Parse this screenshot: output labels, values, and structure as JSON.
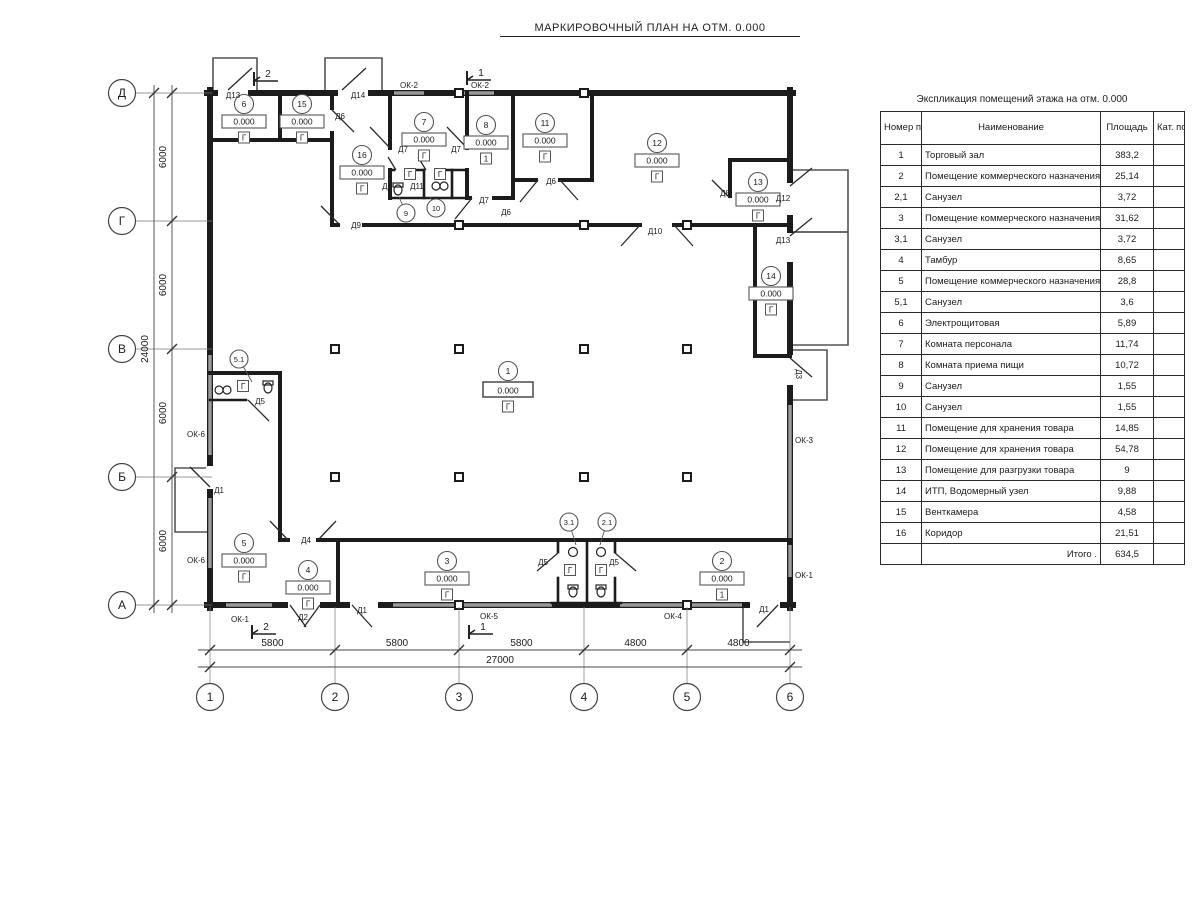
{
  "title": "МАРКИРОВОЧНЫЙ ПЛАН НА ОТМ. 0.000",
  "schedule": {
    "title": "Экспликация помещений этажа на отм. 0.000",
    "headers": {
      "number": "Номер помещ.",
      "name": "Наименование",
      "area": "Площадь",
      "category": "Кат. пом."
    },
    "rows": [
      {
        "number": "1",
        "name": "Торговый зал",
        "area": "383,2",
        "category": ""
      },
      {
        "number": "2",
        "name": "Помещение коммерческого назначения",
        "area": "25,14",
        "category": ""
      },
      {
        "number": "2,1",
        "name": "Санузел",
        "area": "3,72",
        "category": ""
      },
      {
        "number": "3",
        "name": "Помещение коммерческого назначения",
        "area": "31,62",
        "category": ""
      },
      {
        "number": "3,1",
        "name": "Санузел",
        "area": "3,72",
        "category": ""
      },
      {
        "number": "4",
        "name": "Тамбур",
        "area": "8,65",
        "category": ""
      },
      {
        "number": "5",
        "name": "Помещение коммерческого назначения",
        "area": "28,8",
        "category": ""
      },
      {
        "number": "5,1",
        "name": "Санузел",
        "area": "3,6",
        "category": ""
      },
      {
        "number": "6",
        "name": "Электрощитовая",
        "area": "5,89",
        "category": ""
      },
      {
        "number": "7",
        "name": "Комната персонала",
        "area": "11,74",
        "category": ""
      },
      {
        "number": "8",
        "name": "Комната приема пищи",
        "area": "10,72",
        "category": ""
      },
      {
        "number": "9",
        "name": "Санузел",
        "area": "1,55",
        "category": ""
      },
      {
        "number": "10",
        "name": "Санузел",
        "area": "1,55",
        "category": ""
      },
      {
        "number": "11",
        "name": "Помещение для хранения товара",
        "area": "14,85",
        "category": ""
      },
      {
        "number": "12",
        "name": "Помещение для хранения товара",
        "area": "54,78",
        "category": ""
      },
      {
        "number": "13",
        "name": "Помещение для разгрузки товара",
        "area": "9",
        "category": ""
      },
      {
        "number": "14",
        "name": "ИТП, Водомерный узел",
        "area": "9,88",
        "category": ""
      },
      {
        "number": "15",
        "name": "Венткамера",
        "area": "4,58",
        "category": ""
      },
      {
        "number": "16",
        "name": "Коридор",
        "area": "21,51",
        "category": ""
      }
    ],
    "total_label": "Итого .",
    "total_value": "634,5"
  },
  "plan": {
    "elevation": "0.000",
    "axes": {
      "vertical": [
        {
          "label": "Д",
          "y": 93
        },
        {
          "label": "Г",
          "y": 221
        },
        {
          "label": "В",
          "y": 349
        },
        {
          "label": "Б",
          "y": 477
        },
        {
          "label": "А",
          "y": 605
        }
      ],
      "horizontal": [
        {
          "label": "1",
          "x": 210
        },
        {
          "label": "2",
          "x": 335
        },
        {
          "label": "3",
          "x": 459
        },
        {
          "label": "4",
          "x": 584
        },
        {
          "label": "5",
          "x": 687
        },
        {
          "label": "6",
          "x": 790
        }
      ]
    },
    "dimensions": {
      "vertical_segments": [
        "6000",
        "6000",
        "6000",
        "6000"
      ],
      "vertical_total": "24000",
      "horizontal_segments": [
        "5800",
        "5800",
        "5800",
        "4800",
        "4800"
      ],
      "horizontal_total": "27000"
    },
    "room_markers": [
      {
        "n": "1",
        "x": 508,
        "y": 371,
        "cat": "Г",
        "big": true
      },
      {
        "n": "2",
        "x": 722,
        "y": 561,
        "cat": "1"
      },
      {
        "n": "3",
        "x": 447,
        "y": 561,
        "cat": "Г"
      },
      {
        "n": "4",
        "x": 308,
        "y": 570,
        "cat": "Г"
      },
      {
        "n": "5",
        "x": 244,
        "y": 543,
        "cat": "Г"
      },
      {
        "n": "6",
        "x": 244,
        "y": 104,
        "cat": "Г"
      },
      {
        "n": "7",
        "x": 424,
        "y": 122,
        "cat": "Г"
      },
      {
        "n": "8",
        "x": 486,
        "y": 125,
        "cat": "1"
      },
      {
        "n": "11",
        "x": 545,
        "y": 123,
        "cat": "Г"
      },
      {
        "n": "12",
        "x": 657,
        "y": 143,
        "cat": "Г"
      },
      {
        "n": "13",
        "x": 758,
        "y": 182,
        "cat": "Г"
      },
      {
        "n": "14",
        "x": 771,
        "y": 276,
        "cat": "Г"
      },
      {
        "n": "15",
        "x": 302,
        "y": 104,
        "cat": "Г"
      },
      {
        "n": "16",
        "x": 362,
        "y": 155,
        "cat": "Г"
      }
    ],
    "circle_markers": [
      {
        "n": "5.1",
        "x": 239,
        "y": 359,
        "lx": 252,
        "ly": 382
      },
      {
        "n": "3.1",
        "x": 569,
        "y": 522,
        "lx": 576,
        "ly": 545
      },
      {
        "n": "2.1",
        "x": 607,
        "y": 522,
        "lx": 600,
        "ly": 545
      },
      {
        "n": "9",
        "x": 406,
        "y": 213,
        "lx": 399,
        "ly": 197
      },
      {
        "n": "10",
        "x": 436,
        "y": 208,
        "lx": 430,
        "ly": 197
      }
    ],
    "cat_boxes": [
      {
        "t": "Г",
        "x": 243,
        "y": 389
      },
      {
        "t": "Г",
        "x": 570,
        "y": 573
      },
      {
        "t": "Г",
        "x": 601,
        "y": 573
      },
      {
        "t": "Г",
        "x": 410,
        "y": 177
      },
      {
        "t": "Г",
        "x": 440,
        "y": 177
      }
    ],
    "door_labels": [
      {
        "t": "Д13",
        "x": 233,
        "y": 98
      },
      {
        "t": "Д14",
        "x": 358,
        "y": 98
      },
      {
        "t": "Д6",
        "x": 340,
        "y": 119
      },
      {
        "t": "Д7",
        "x": 403,
        "y": 152
      },
      {
        "t": "Д7",
        "x": 456,
        "y": 152
      },
      {
        "t": "Д5",
        "x": 387,
        "y": 189
      },
      {
        "t": "Д11",
        "x": 417,
        "y": 189
      },
      {
        "t": "Д7",
        "x": 484,
        "y": 203
      },
      {
        "t": "Д6",
        "x": 506,
        "y": 215
      },
      {
        "t": "Д6",
        "x": 551,
        "y": 184
      },
      {
        "t": "Д9",
        "x": 356,
        "y": 228
      },
      {
        "t": "Д10",
        "x": 655,
        "y": 234
      },
      {
        "t": "Д8",
        "x": 725,
        "y": 196
      },
      {
        "t": "Д12",
        "x": 783,
        "y": 201
      },
      {
        "t": "Д13",
        "x": 783,
        "y": 243
      },
      {
        "t": "Д3",
        "x": 796,
        "y": 374,
        "r": 90
      },
      {
        "t": "Д5",
        "x": 260,
        "y": 404
      },
      {
        "t": "Д1",
        "x": 219,
        "y": 493
      },
      {
        "t": "Д4",
        "x": 306,
        "y": 543
      },
      {
        "t": "Д2",
        "x": 303,
        "y": 620
      },
      {
        "t": "Д1",
        "x": 362,
        "y": 613
      },
      {
        "t": "Д5",
        "x": 543,
        "y": 565
      },
      {
        "t": "Д5",
        "x": 614,
        "y": 565
      },
      {
        "t": "Д1",
        "x": 764,
        "y": 612
      }
    ],
    "window_labels": [
      {
        "t": "ОК-2",
        "x": 409,
        "y": 88
      },
      {
        "t": "ОК-2",
        "x": 480,
        "y": 88
      },
      {
        "t": "ОК-6",
        "x": 196,
        "y": 437
      },
      {
        "t": "ОК-6",
        "x": 196,
        "y": 563
      },
      {
        "t": "ОК-1",
        "x": 240,
        "y": 622
      },
      {
        "t": "ОК-5",
        "x": 489,
        "y": 619
      },
      {
        "t": "ОК-4",
        "x": 673,
        "y": 619
      },
      {
        "t": "ОК-1",
        "x": 804,
        "y": 578
      },
      {
        "t": "ОК-3",
        "x": 804,
        "y": 443
      }
    ],
    "section_markers": [
      {
        "t": "2",
        "x": 262,
        "y": 76
      },
      {
        "t": "1",
        "x": 475,
        "y": 75
      },
      {
        "t": "2",
        "x": 260,
        "y": 629
      },
      {
        "t": "1",
        "x": 477,
        "y": 629
      }
    ]
  }
}
